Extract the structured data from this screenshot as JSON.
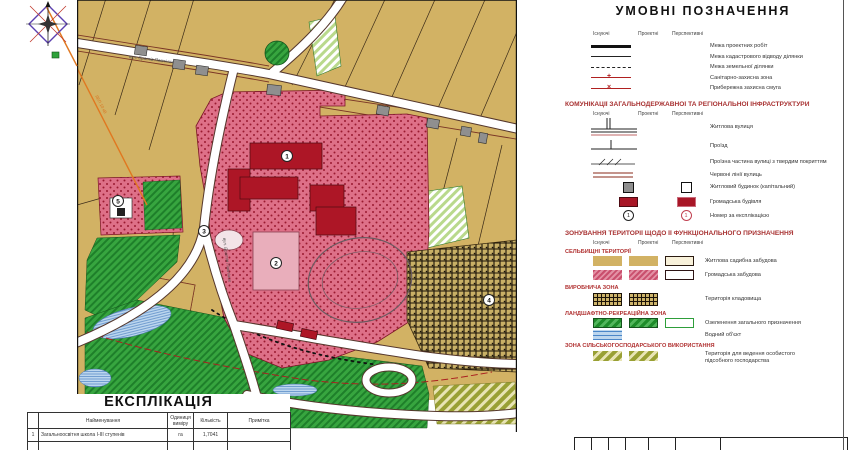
{
  "map": {
    "street_top": "вул. Братів Павліних",
    "street_side": "вул. Братів Павліних",
    "powerline_label": "ЛЕП 10 кВ",
    "markers": {
      "m1": "1",
      "m2": "2",
      "m3": "3",
      "m4": "4",
      "m5": "5"
    },
    "colors": {
      "field_tan": "#d2b264",
      "public_pink": "#de7088",
      "building_red": "#ad1626",
      "green": "#2ea23a",
      "water_blue": "#bcd6ee",
      "cemetery_tan": "#c9b066",
      "road_white": "#ffffff",
      "accent_red": "#a83232"
    }
  },
  "legend": {
    "title": "УМОВНІ ПОЗНАЧЕННЯ",
    "col_headers": [
      "Існуючі",
      "Проектні",
      "Перспективні"
    ],
    "boundary_items": [
      "Межа проектних робіт",
      "Межа кадастрового відводу ділянки",
      "Межа земельної ділянки",
      "Санітарно-захисна зона",
      "Прибережна захисна смуга"
    ],
    "comms_title": "КОМУНІКАЦІЇ ЗАГАЛЬНОДЕРЖАВНОЇ ТА РЕГІОНАЛЬНОЇ ІНФРАСТРУКТУРИ",
    "comms_items": [
      "Житлова вулиця",
      "Проїзд",
      "Проїзна частина вулиці з твердим покриттям",
      "Червоні лінії вулиць",
      "Житловий будинок (капітальний)",
      "Громадська будівля",
      "Номер за експлікацією"
    ],
    "zoning_title": "ЗОНУВАННЯ ТЕРИТОРІЇ ЩОДО ЇЇ ФУНКЦІОНАЛЬНОГО ПРИЗНАЧЕННЯ",
    "zone_sections": [
      {
        "name": "СЕЛЬБИЩНІ ТЕРИТОРІЇ",
        "items": [
          "Житлова садибна забудова",
          "Громадська забудова"
        ]
      },
      {
        "name": "ВИРОБНИЧА ЗОНА",
        "items": [
          "Територія кладовища"
        ]
      },
      {
        "name": "ЛАНДШАФТНО-РЕКРЕАЦІЙНА ЗОНА",
        "items": [
          "Озеленення загального призначення",
          "Водний об'єкт"
        ]
      },
      {
        "name": "ЗОНА СІЛЬСЬКОГОСПОДАРСЬКОГО ВИКОРИСТАННЯ",
        "items": [
          "Територія для ведення особистого підсобного господарства"
        ]
      }
    ]
  },
  "explication": {
    "title": "ЕКСПЛІКАЦІЯ",
    "headers": [
      "Найменування",
      "Одиниця виміру",
      "Кількість",
      "Примітка"
    ],
    "rows": [
      {
        "num": "1",
        "name": "Загальноосвітня школа I-III ступенів",
        "unit": "га",
        "qty": "1,7041",
        "note": ""
      }
    ]
  }
}
